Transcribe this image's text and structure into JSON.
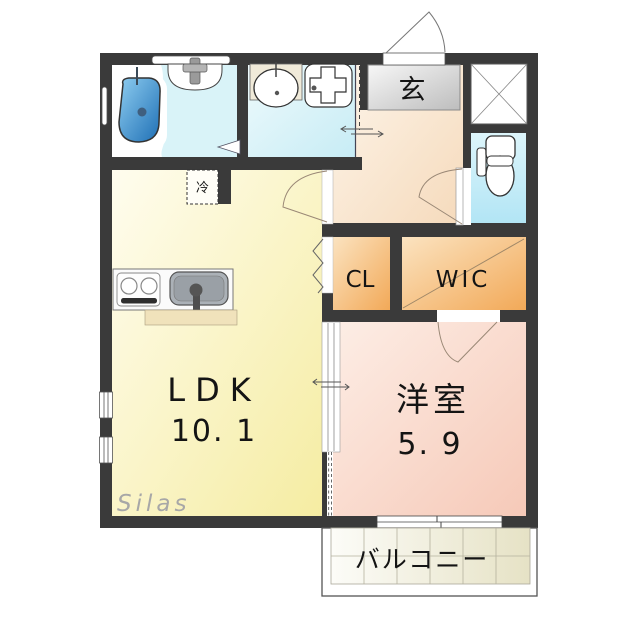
{
  "plan": {
    "ldk": {
      "label": "LDK",
      "area": "10. 1"
    },
    "western_room": {
      "label": "洋室",
      "area": "5. 9"
    },
    "closet": {
      "label": "CL"
    },
    "walk_in_closet": {
      "label": "WIC"
    },
    "entrance": {
      "label": "玄"
    },
    "refrigerator": {
      "label": "冷"
    },
    "balcony": {
      "label": "バルコニー"
    }
  },
  "watermark": {
    "text": "Silas"
  },
  "colors": {
    "wall": "#3a3a3a",
    "ldk_fill": "#f6eda4",
    "western_room_fill": "#f7cbbb",
    "closet_fill": "#f3ab5e",
    "hall_fill": "#f6d9b9",
    "wet_area_fill": "#cdeef6",
    "entrance_box_fill": "#c2c2c2",
    "bathtub_fill": "#1e72b8",
    "balcony_tile_fill": "#e7e3c6"
  }
}
